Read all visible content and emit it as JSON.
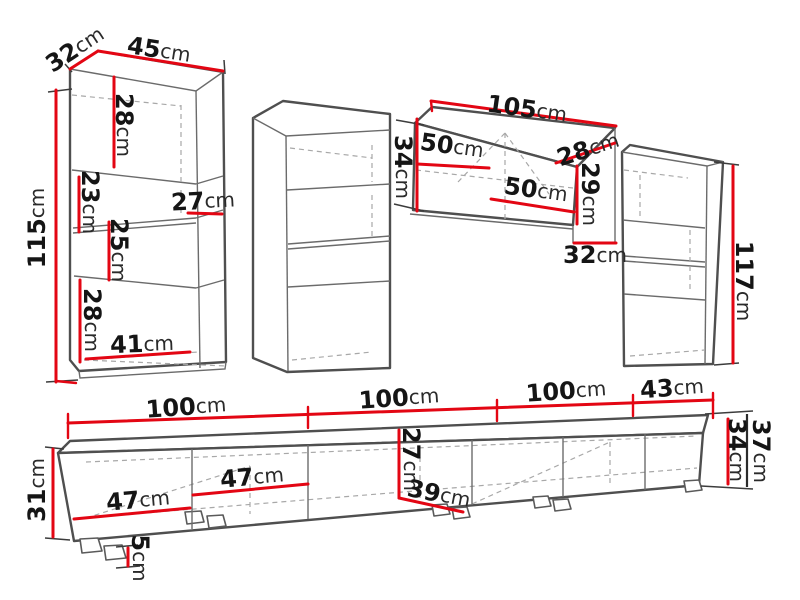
{
  "diagram": {
    "title": "Wall unit furniture dimension drawing",
    "unit": "cm",
    "colors": {
      "dimension_line": "#e30613",
      "outline": "#4f4f4f",
      "hidden_line": "#a8a8a8",
      "label_text": "#151515",
      "background": "#ffffff"
    },
    "pieces": {
      "left_cabinet": {
        "depth": {
          "v": "32",
          "u": "cm"
        },
        "width": {
          "v": "45",
          "u": "cm"
        },
        "height": {
          "v": "115",
          "u": "cm"
        },
        "top_section": {
          "v": "28",
          "u": "cm"
        },
        "upper_niche": {
          "v": "23",
          "u": "cm"
        },
        "shelf_depth": {
          "v": "27",
          "u": "cm"
        },
        "lower_niche": {
          "v": "25",
          "u": "cm"
        },
        "bottom_section": {
          "v": "28",
          "u": "cm"
        },
        "bottom_width": {
          "v": "41",
          "u": "cm"
        }
      },
      "wall_cabinet": {
        "width": {
          "v": "105",
          "u": "cm"
        },
        "left_inner_width": {
          "v": "50",
          "u": "cm"
        },
        "right_inner_width": {
          "v": "50",
          "u": "cm"
        },
        "height": {
          "v": "34",
          "u": "cm"
        },
        "depth": {
          "v": "28",
          "u": "cm"
        },
        "inner_height": {
          "v": "29",
          "u": "cm"
        },
        "side_depth": {
          "v": "32",
          "u": "cm"
        }
      },
      "right_cabinet": {
        "height": {
          "v": "117",
          "u": "cm"
        }
      },
      "tv_stand": {
        "segment1": {
          "v": "100",
          "u": "cm"
        },
        "segment2": {
          "v": "100",
          "u": "cm"
        },
        "segment3": {
          "v": "100",
          "u": "cm"
        },
        "segment4": {
          "v": "43",
          "u": "cm"
        },
        "front_height": {
          "v": "31",
          "u": "cm"
        },
        "door1_width": {
          "v": "47",
          "u": "cm"
        },
        "door2_width": {
          "v": "47",
          "u": "cm"
        },
        "inner_height": {
          "v": "27",
          "u": "cm"
        },
        "inner_depth": {
          "v": "39",
          "u": "cm"
        },
        "right_inner_height": {
          "v": "34",
          "u": "cm"
        },
        "total_height": {
          "v": "37",
          "u": "cm"
        },
        "foot_height": {
          "v": "5",
          "u": "cm"
        }
      }
    }
  }
}
